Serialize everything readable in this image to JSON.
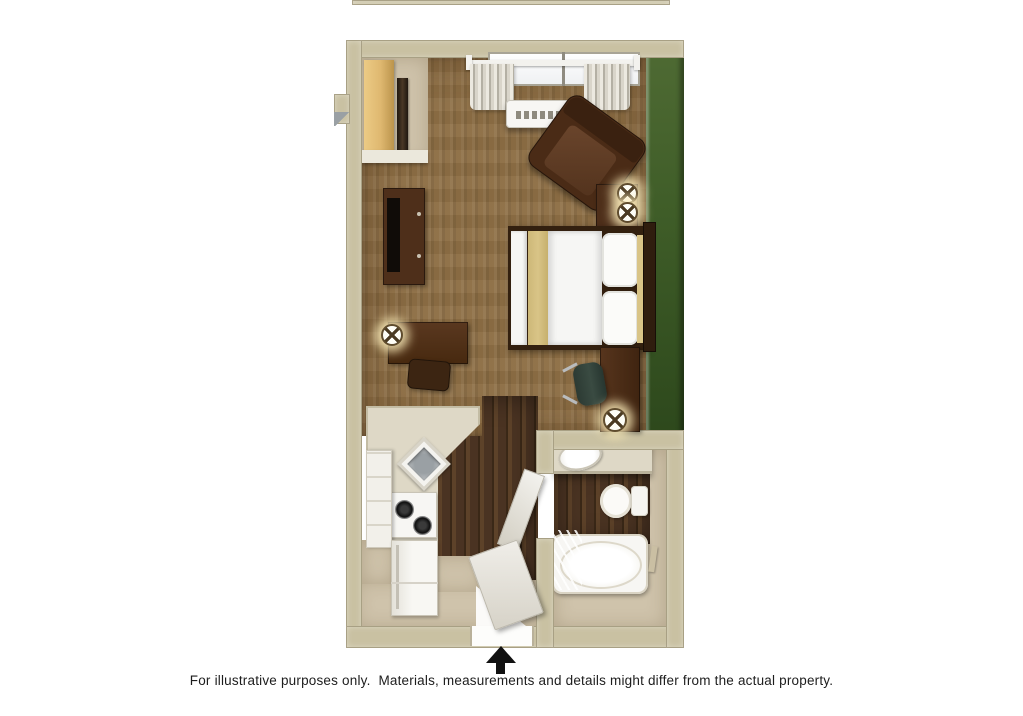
{
  "caption": {
    "text": "For illustrative purposes only.  Materials, measurements and details might differ from the actual property."
  },
  "icons": {
    "table_lamp": "starburst-glow-circle",
    "north_arrow": "solid-black-triangle-up-with-stem"
  },
  "palette": {
    "wall": "#c9c1a2",
    "wall_inner": "#ddd6bf",
    "accent_green": "#3f5d28",
    "accent_green_dark": "#2d481c",
    "carpet": "#8d6e44",
    "wood": "#4a3322",
    "wood_light": "#5d4229",
    "wood_dark": "#3a2817",
    "floor_beige": "#cfc3ab",
    "counter": "#ded8c6",
    "cabinet_white": "#f2f0ea",
    "furniture_brown": "#4e2f1a",
    "furniture_dark": "#33200f",
    "linen_white": "#f6f6f4",
    "fabric_tan": "#d9c487",
    "chair_teal": "#3a4b42",
    "fixture_white": "#f7f6f3",
    "maple": "#dfb870",
    "arrow_black": "#111111",
    "caption_color": "#1d1d1d"
  }
}
